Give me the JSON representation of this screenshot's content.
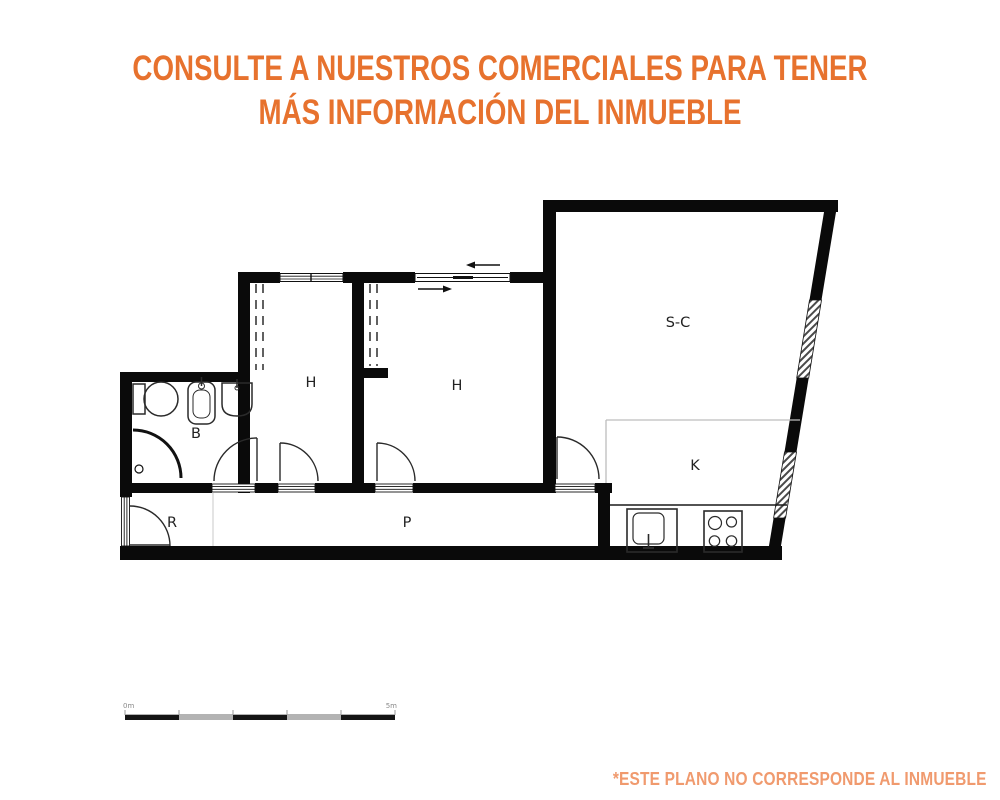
{
  "header": {
    "line1": "CONSULTE A NUESTROS COMERCIALES PARA TENER",
    "line2": "MÁS INFORMACIÓN DEL INMUEBLE"
  },
  "footer": {
    "disclaimer": "*ESTE PLANO NO CORRESPONDE AL INMUEBLE"
  },
  "colors": {
    "header_orange": "#E7722E",
    "footer_orange": "#F09A6E",
    "wall_black": "#0a0a0a",
    "divider_gray": "#bdbdbd"
  },
  "floorplan": {
    "rooms": [
      {
        "id": "living-dining",
        "label": "S-C"
      },
      {
        "id": "bedroom-1",
        "label": "H"
      },
      {
        "id": "bedroom-2",
        "label": "H"
      },
      {
        "id": "bathroom",
        "label": "B"
      },
      {
        "id": "kitchen",
        "label": "K"
      },
      {
        "id": "entry-hall",
        "label": "R"
      },
      {
        "id": "corridor",
        "label": "P"
      }
    ],
    "scale_bar": {
      "start_label": "0m",
      "end_label": "5m"
    }
  }
}
